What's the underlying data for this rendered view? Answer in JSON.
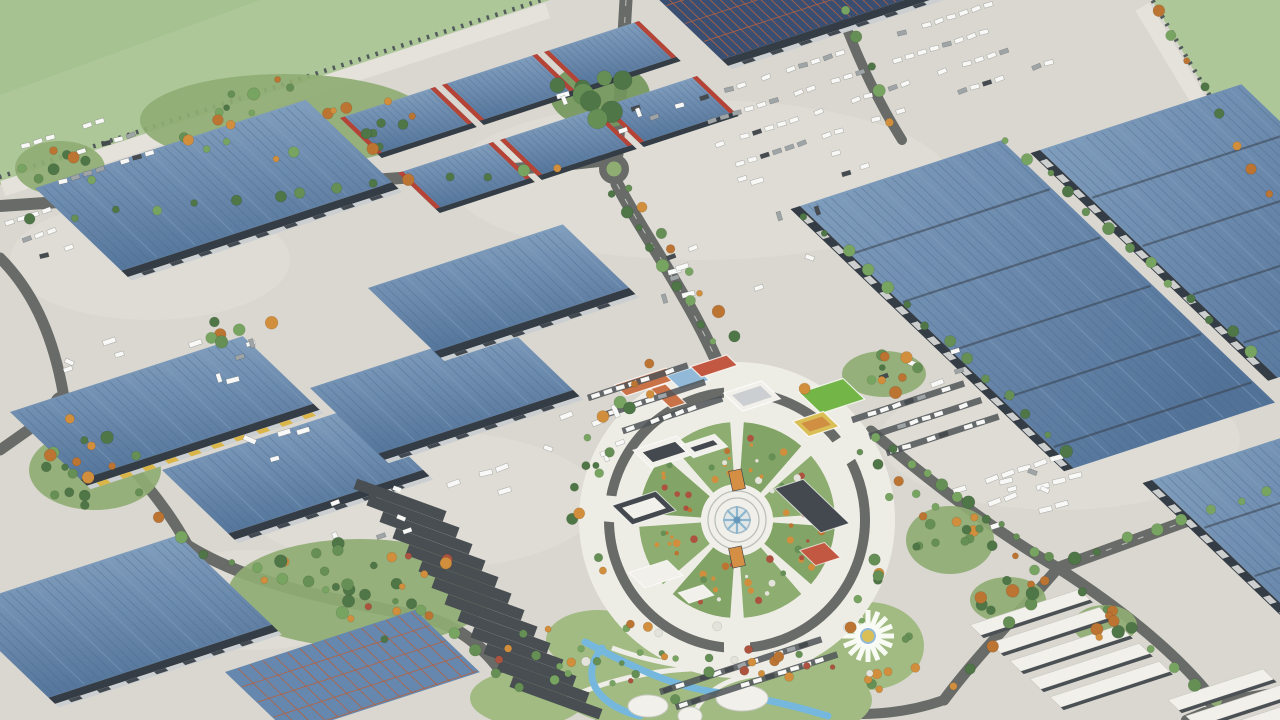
{
  "meta": {
    "title": "Aerial rendering of an industrial logistics park",
    "description": "Computer-generated oblique aerial view of an industrial park masterplan: large blue-roofed warehouse halls, a central circular landscaped plaza with fountain, roads with roundabouts, parking lots, gardens with autumn trees, and green fields at the top corners. No text or UI elements are visible."
  },
  "palette": {
    "pavement": "#d7d5cd",
    "pavement_light": "#e3e1d9",
    "plaza_white": "#eeece4",
    "path_white": "#efede6",
    "grass": "#a9c493",
    "grass_dark": "#9cba85",
    "road": "#60645f",
    "road_mark": "#cfd2cc",
    "fence": "#4a5254",
    "roof_blue": "#5e82aa",
    "roof_blue_light": "#85a3c2",
    "roof_blue_dark": "#47688f",
    "roof_ridge": "#3e5f85",
    "hall_roof": "#54779f",
    "hall_light": "#7d9cbd",
    "eave": "#2a323b",
    "wall": "#c9cdcf",
    "door_dark": "#394048",
    "dock_yellow": "#d8b23f",
    "red_accent": "#b13a2c",
    "solar_navy": "#2f4569",
    "solar_grid": "#b05a3a",
    "garden": "#8aa86b",
    "garden_dark": "#6d9155",
    "park_green": "#9cb87c",
    "wedge_green": "#7da05f",
    "wedge_green2": "#88a96a",
    "tree_green_1": "#466f3e",
    "tree_green_2": "#5d8a4c",
    "tree_green_3": "#71a05a",
    "tree_autumn_1": "#cf8832",
    "tree_autumn_2": "#b96d28",
    "shrub_red": "#a84a36",
    "flower_white": "#e3e2da",
    "stream": "#6fb5dc",
    "pool": "#8db7d6",
    "field_green": "#6db23e",
    "court_yellow": "#d9bc4e",
    "court_orange": "#cf8a3a",
    "kiosk_orange": "#d28a3c",
    "orange_roof": "#c76b3e",
    "red_roof": "#bf4f38",
    "bldg_white": "#f2f0ea",
    "bldg_dark": "#3a4046",
    "slab_edge": "#41474b",
    "carport": "#3f4549",
    "car_white": "#f8f8f6",
    "car_dark": "#3c4246",
    "car_gray": "#9aa0a2"
  },
  "scene": {
    "skew": {
      "u": [
        0.95,
        -0.31
      ],
      "v": [
        0.72,
        0.69
      ]
    },
    "grass": [
      {
        "name": "grass-field-top-left",
        "pts": "0,0 550,0 0,185"
      },
      {
        "name": "grass-field-top-right",
        "pts": "1152,0 1280,0 1280,215"
      }
    ],
    "perimeter": [
      {
        "line": [
          0,
          180,
          545,
          2
        ]
      },
      {
        "line": [
          1150,
          2,
          1276,
          212
        ]
      }
    ],
    "patches": [
      {
        "x": 700,
        "y": 180,
        "rx": 250,
        "ry": 80
      },
      {
        "x": 420,
        "y": 500,
        "rx": 180,
        "ry": 70
      },
      {
        "x": 1060,
        "y": 440,
        "rx": 180,
        "ry": 70
      },
      {
        "x": 250,
        "y": 600,
        "rx": 120,
        "ry": 50
      },
      {
        "x": 150,
        "y": 260,
        "rx": 140,
        "ry": 60
      }
    ],
    "roads": [
      {
        "d": "M626,0 L617,154",
        "w": 13,
        "mark": true
      },
      {
        "d": "M599,161 C520,170 300,186 0,206",
        "w": 12
      },
      {
        "d": "M617,184 C648,244 700,310 731,396",
        "w": 13,
        "mark": true
      },
      {
        "d": "M871,431 C942,492 1005,537 1058,568",
        "w": 11
      },
      {
        "d": "M1058,568 L1280,487",
        "w": 12,
        "mark": true
      },
      {
        "d": "M1058,568 C1020,612 975,658 944,700",
        "w": 11
      },
      {
        "d": "M1058,568 C1120,608 1175,652 1211,697",
        "w": 11
      },
      {
        "d": "M1228,700 L1280,692",
        "w": 10
      },
      {
        "d": "M1205,712 L1186,720",
        "w": 10
      },
      {
        "d": "M63,392 C52,330 30,288 0,258",
        "w": 11
      },
      {
        "d": "M51,414 L0,450",
        "w": 11
      },
      {
        "d": "M76,413 C120,452 162,498 188,546",
        "w": 11
      },
      {
        "d": "M188,546 C260,590 352,602 428,618 C478,632 512,678 528,720",
        "w": 12
      },
      {
        "d": "M188,546 C150,578 80,612 0,640",
        "w": 11
      },
      {
        "d": "M836,0 C852,44 872,92 902,140",
        "w": 10
      },
      {
        "d": "M600,720 C660,704 730,700 800,710 C860,718 905,714 944,700",
        "w": 10
      }
    ],
    "roundabouts": [
      {
        "x": 614,
        "y": 169,
        "r": 15
      },
      {
        "x": 63,
        "y": 404,
        "r": 13
      },
      {
        "x": 1216,
        "y": 700,
        "r": 12
      }
    ],
    "gardens": [
      {
        "x": 285,
        "y": 120,
        "rx": 145,
        "ry": 46,
        "fill": "garden"
      },
      {
        "x": 60,
        "y": 168,
        "rx": 45,
        "ry": 27,
        "fill": "garden"
      },
      {
        "x": 95,
        "y": 470,
        "rx": 66,
        "ry": 40,
        "fill": "garden"
      },
      {
        "x": 360,
        "y": 593,
        "rx": 132,
        "ry": 54,
        "fill": "garden"
      },
      {
        "x": 884,
        "y": 374,
        "rx": 42,
        "ry": 23,
        "fill": "garden"
      },
      {
        "x": 950,
        "y": 540,
        "rx": 44,
        "ry": 34,
        "fill": "garden"
      },
      {
        "x": 1008,
        "y": 600,
        "rx": 38,
        "ry": 23,
        "fill": "garden"
      },
      {
        "x": 1105,
        "y": 625,
        "rx": 32,
        "ry": 20,
        "fill": "garden"
      },
      {
        "x": 600,
        "y": 95,
        "rx": 50,
        "ry": 33,
        "fill": "garden_dark"
      }
    ],
    "park": {
      "blobs": [
        {
          "x": 640,
          "y": 680,
          "rx": 88,
          "ry": 46
        },
        {
          "x": 780,
          "y": 700,
          "rx": 92,
          "ry": 40
        },
        {
          "x": 598,
          "y": 640,
          "rx": 52,
          "ry": 30
        },
        {
          "x": 868,
          "y": 646,
          "rx": 56,
          "ry": 44
        },
        {
          "x": 528,
          "y": 698,
          "rx": 58,
          "ry": 28
        }
      ],
      "stream": [
        "M585,642 C635,668 675,688 722,693 C760,697 795,706 828,716",
        "M602,648 C575,682 606,708 640,716"
      ],
      "paths": [
        "M560,702 C620,672 700,660 762,676",
        "M692,720 C700,692 730,674 772,674",
        "M612,648 C650,662 690,668 724,670"
      ],
      "daisy": {
        "x": 868,
        "y": 636,
        "r": 26,
        "petals": 16
      },
      "canopies": [
        {
          "x": 742,
          "y": 698,
          "rx": 26,
          "ry": 13
        },
        {
          "x": 648,
          "y": 706,
          "rx": 20,
          "ry": 11
        },
        {
          "x": 690,
          "y": 716,
          "rx": 12,
          "ry": 9
        }
      ]
    },
    "plaza": {
      "cx": 737,
      "cy": 520,
      "apron_r": 158,
      "ring_r": 128,
      "ring_w": 10,
      "wedge_r": [
        36,
        98
      ],
      "inner_r": 36,
      "inner_rings": [
        22,
        29
      ],
      "fountain_r": 13,
      "breaks": [
        -90,
        -33,
        90,
        185
      ],
      "kiosks": [
        [
          737,
          480
        ],
        [
          737,
          557
        ]
      ],
      "buildings": [
        {
          "name": "plaza-building-northwest",
          "x": 664,
          "y": 452,
          "l": 46,
          "w": 26,
          "fill": "bldg_white",
          "inset": "bldg_dark"
        },
        {
          "name": "plaza-building-north",
          "x": 704,
          "y": 446,
          "l": 36,
          "w": 18,
          "fill": "bldg_white",
          "inset": "bldg_dark"
        },
        {
          "name": "plaza-building-west",
          "x": 644,
          "y": 508,
          "l": 46,
          "w": 28,
          "fill": "bldg_dark",
          "inset": "bldg_white"
        },
        {
          "name": "plaza-building-southwest",
          "x": 656,
          "y": 574,
          "l": 40,
          "w": 22,
          "fill": "bldg_white"
        },
        {
          "name": "plaza-building-southwest-2",
          "x": 696,
          "y": 594,
          "l": 26,
          "w": 15,
          "fill": "bldg_white"
        },
        {
          "name": "plaza-building-east",
          "x": 812,
          "y": 506,
          "l": 30,
          "w": 64,
          "fill": "bldg_dark"
        },
        {
          "name": "plaza-building-east-red-wing",
          "x": 820,
          "y": 554,
          "l": 26,
          "w": 22,
          "fill": "red_roof"
        }
      ]
    },
    "north_cluster": [
      {
        "name": "orange-roof-building",
        "x": 646,
        "y": 382,
        "l": 54,
        "w": 16,
        "fill": "orange_roof"
      },
      {
        "name": "orange-roof-building-wing",
        "x": 668,
        "y": 396,
        "l": 16,
        "w": 28,
        "fill": "orange_roof"
      },
      {
        "name": "swimming-pool",
        "x": 688,
        "y": 378,
        "l": 30,
        "w": 20,
        "fill": "pool"
      },
      {
        "name": "red-roof-building",
        "x": 714,
        "y": 366,
        "l": 38,
        "w": 15,
        "fill": "red_roof"
      },
      {
        "name": "white-office-building",
        "x": 752,
        "y": 396,
        "l": 40,
        "w": 26,
        "fill": "bldg_white",
        "inset": "wall"
      },
      {
        "name": "sports-field",
        "x": 832,
        "y": 396,
        "l": 46,
        "w": 30,
        "fill": "field_green"
      },
      {
        "name": "sports-court",
        "x": 816,
        "y": 424,
        "l": 32,
        "w": 22,
        "fill": "court_yellow",
        "inset": "court_orange"
      }
    ],
    "warehouses": [
      {
        "name": "warehouse-top-left",
        "p": [
          35,
          188
        ],
        "l": 285,
        "w": 120,
        "style": "blue"
      },
      {
        "name": "warehouse-left-mid",
        "p": [
          10,
          412
        ],
        "l": 245,
        "w": 98,
        "style": "blue",
        "dock": "yellow"
      },
      {
        "name": "warehouse-left-bottom",
        "p": [
          -45,
          608
        ],
        "l": 235,
        "w": 130,
        "style": "blue"
      },
      {
        "name": "warehouse-mid-lower",
        "p": [
          162,
          470
        ],
        "l": 205,
        "w": 92,
        "style": "blue"
      },
      {
        "name": "warehouse-mid",
        "p": [
          310,
          388
        ],
        "l": 205,
        "w": 95,
        "style": "blue"
      },
      {
        "name": "warehouse-mid-upper",
        "p": [
          368,
          288
        ],
        "l": 205,
        "w": 92,
        "style": "blue"
      },
      {
        "name": "hall-right-west",
        "p": [
          800,
          206
        ],
        "l": 212,
        "w": 380,
        "style": "hall"
      },
      {
        "name": "hall-right-east",
        "p": [
          1040,
          150
        ],
        "l": 212,
        "w": 330,
        "style": "hall"
      },
      {
        "name": "hall-right-south",
        "p": [
          1152,
          480
        ],
        "l": 212,
        "w": 300,
        "style": "hall"
      },
      {
        "name": "warehouse-rooftop-solar",
        "p": [
          628,
          -30
        ],
        "l": 240,
        "w": 130,
        "style": "solar"
      },
      {
        "name": "warehouse-red-grid-bottom",
        "p": [
          225,
          672
        ],
        "l": 200,
        "w": 90,
        "style": "solargrid2"
      }
    ],
    "cluster_units": [
      {
        "p": [
          340,
          118
        ]
      },
      {
        "p": [
          442,
          85
        ]
      },
      {
        "p": [
          544,
          52
        ]
      },
      {
        "p": [
          398,
          173
        ]
      },
      {
        "p": [
          500,
          140
        ]
      },
      {
        "p": [
          602,
          107
        ]
      }
    ],
    "cluster_unit_size": {
      "l": 100,
      "w": 52
    },
    "carport": {
      "p": [
        400,
        500
      ],
      "slabs": 13,
      "step": [
        13,
        16.5
      ],
      "slab_l": 95,
      "slab_w": 11,
      "angle": 20
    },
    "white_slabs": [
      {
        "p": [
          970,
          625
        ],
        "n": 5,
        "step": [
          20,
          18
        ],
        "l": 115,
        "w": 15
      },
      {
        "p": [
          1168,
          700
        ],
        "n": 3,
        "step": [
          18,
          16
        ],
        "l": 100,
        "w": 15
      }
    ],
    "lots": [
      {
        "o": [
          672,
          108
        ],
        "rows": 4,
        "gap": 28,
        "len": 340,
        "kind": "car"
      },
      {
        "o": [
          18,
          148
        ],
        "rows": 3,
        "gap": 26,
        "len": 120,
        "kind": "car"
      },
      {
        "o": [
          2,
          225
        ],
        "rows": 3,
        "gap": 24,
        "len": 60,
        "kind": "car"
      },
      {
        "o": [
          588,
          398
        ],
        "rows": 3,
        "gap": 24,
        "len": 105,
        "kind": "car",
        "strip": true
      },
      {
        "o": [
          852,
          420
        ],
        "rows": 3,
        "gap": 24,
        "len": 118,
        "kind": "car",
        "strip": true
      },
      {
        "o": [
          660,
          692
        ],
        "rows": 2,
        "gap": 22,
        "len": 170,
        "kind": "car",
        "strip": true
      },
      {
        "o": [
          952,
          492
        ],
        "rows": 3,
        "gap": 26,
        "len": 125,
        "kind": "truck"
      },
      {
        "o": [
          446,
          486
        ],
        "rows": 2,
        "gap": 26,
        "len": 100,
        "kind": "truck"
      }
    ],
    "scatter_cars": [
      [
        540,
        400,
        120,
        60,
        8
      ],
      [
        660,
        230,
        150,
        90,
        9
      ],
      [
        330,
        500,
        90,
        40,
        5
      ],
      [
        880,
        340,
        80,
        50,
        5
      ],
      [
        1000,
        468,
        70,
        36,
        4
      ],
      [
        60,
        330,
        60,
        50,
        4
      ],
      [
        560,
        84,
        100,
        56,
        6
      ],
      [
        240,
        430,
        80,
        40,
        4
      ],
      [
        170,
        340,
        120,
        50,
        6
      ],
      [
        740,
        150,
        130,
        70,
        7
      ]
    ],
    "tree_lines": [
      {
        "l": [
          612,
          192,
          716,
          340
        ],
        "n": 9,
        "type": "green"
      },
      {
        "l": [
          630,
          190,
          732,
          334
        ],
        "n": 8,
        "type": "mixed"
      },
      {
        "l": [
          560,
          168,
          300,
          192
        ],
        "n": 8,
        "type": "mixed"
      },
      {
        "l": [
          280,
          198,
          30,
          220
        ],
        "n": 7,
        "type": "green"
      },
      {
        "l": [
          878,
          440,
          1048,
          560
        ],
        "n": 12,
        "type": "green"
      },
      {
        "l": [
          860,
          452,
          1032,
          572
        ],
        "n": 10,
        "type": "mixed"
      },
      {
        "l": [
          1072,
          560,
          1268,
          492
        ],
        "n": 8,
        "type": "green"
      },
      {
        "l": [
          1048,
          582,
          952,
          688
        ],
        "n": 6,
        "type": "mixed"
      },
      {
        "l": [
          1085,
          592,
          1198,
          686
        ],
        "n": 6,
        "type": "green"
      },
      {
        "l": [
          1008,
          140,
          1252,
          352
        ],
        "n": 13,
        "type": "green"
      },
      {
        "l": [
          846,
          8,
          892,
          122
        ],
        "n": 5,
        "type": "mixed"
      },
      {
        "l": [
          1158,
          10,
          1268,
          196
        ],
        "n": 8,
        "type": "mixed"
      },
      {
        "l": [
          72,
          420,
          180,
          538
        ],
        "n": 6,
        "type": "mixed"
      },
      {
        "l": [
          202,
          556,
          420,
          610
        ],
        "n": 9,
        "type": "green"
      },
      {
        "l": [
          432,
          616,
          520,
          688
        ],
        "n": 5,
        "type": "mixed"
      },
      {
        "l": [
          806,
          216,
          1068,
          452
        ],
        "n": 14,
        "type": "green"
      },
      {
        "l": [
          652,
          362,
          606,
          418
        ],
        "n": 4,
        "type": "mixed"
      },
      {
        "l": [
          588,
          440,
          572,
          516
        ],
        "n": 4,
        "type": "mixed"
      }
    ],
    "tree_clusters": [
      {
        "x": 285,
        "y": 118,
        "rx": 138,
        "ry": 44,
        "n": 26,
        "type": "mixed"
      },
      {
        "x": 60,
        "y": 168,
        "rx": 40,
        "ry": 25,
        "n": 8,
        "type": "mixed"
      },
      {
        "x": 95,
        "y": 470,
        "rx": 62,
        "ry": 36,
        "n": 14,
        "type": "mixed"
      },
      {
        "x": 360,
        "y": 592,
        "rx": 126,
        "ry": 50,
        "n": 26,
        "type": "mixed-red"
      },
      {
        "x": 600,
        "y": 95,
        "rx": 46,
        "ry": 30,
        "n": 8,
        "type": "big-green"
      },
      {
        "x": 884,
        "y": 374,
        "rx": 40,
        "ry": 21,
        "n": 9,
        "type": "mixed"
      },
      {
        "x": 950,
        "y": 538,
        "rx": 40,
        "ry": 30,
        "n": 10,
        "type": "mixed"
      },
      {
        "x": 1008,
        "y": 598,
        "rx": 34,
        "ry": 20,
        "n": 7,
        "type": "mixed"
      },
      {
        "x": 700,
        "y": 660,
        "rx": 118,
        "ry": 44,
        "n": 22,
        "type": "park"
      },
      {
        "x": 540,
        "y": 660,
        "rx": 56,
        "ry": 32,
        "n": 10,
        "type": "park"
      },
      {
        "x": 868,
        "y": 655,
        "rx": 52,
        "ry": 38,
        "n": 12,
        "type": "park"
      },
      {
        "x": 1105,
        "y": 625,
        "rx": 28,
        "ry": 18,
        "n": 6,
        "type": "mixed"
      },
      {
        "ring": [
          737,
          520,
          150
        ],
        "n": 22,
        "type": "mixed"
      },
      {
        "x": 240,
        "y": 330,
        "rx": 50,
        "ry": 22,
        "n": 6,
        "type": "mixed"
      }
    ]
  }
}
